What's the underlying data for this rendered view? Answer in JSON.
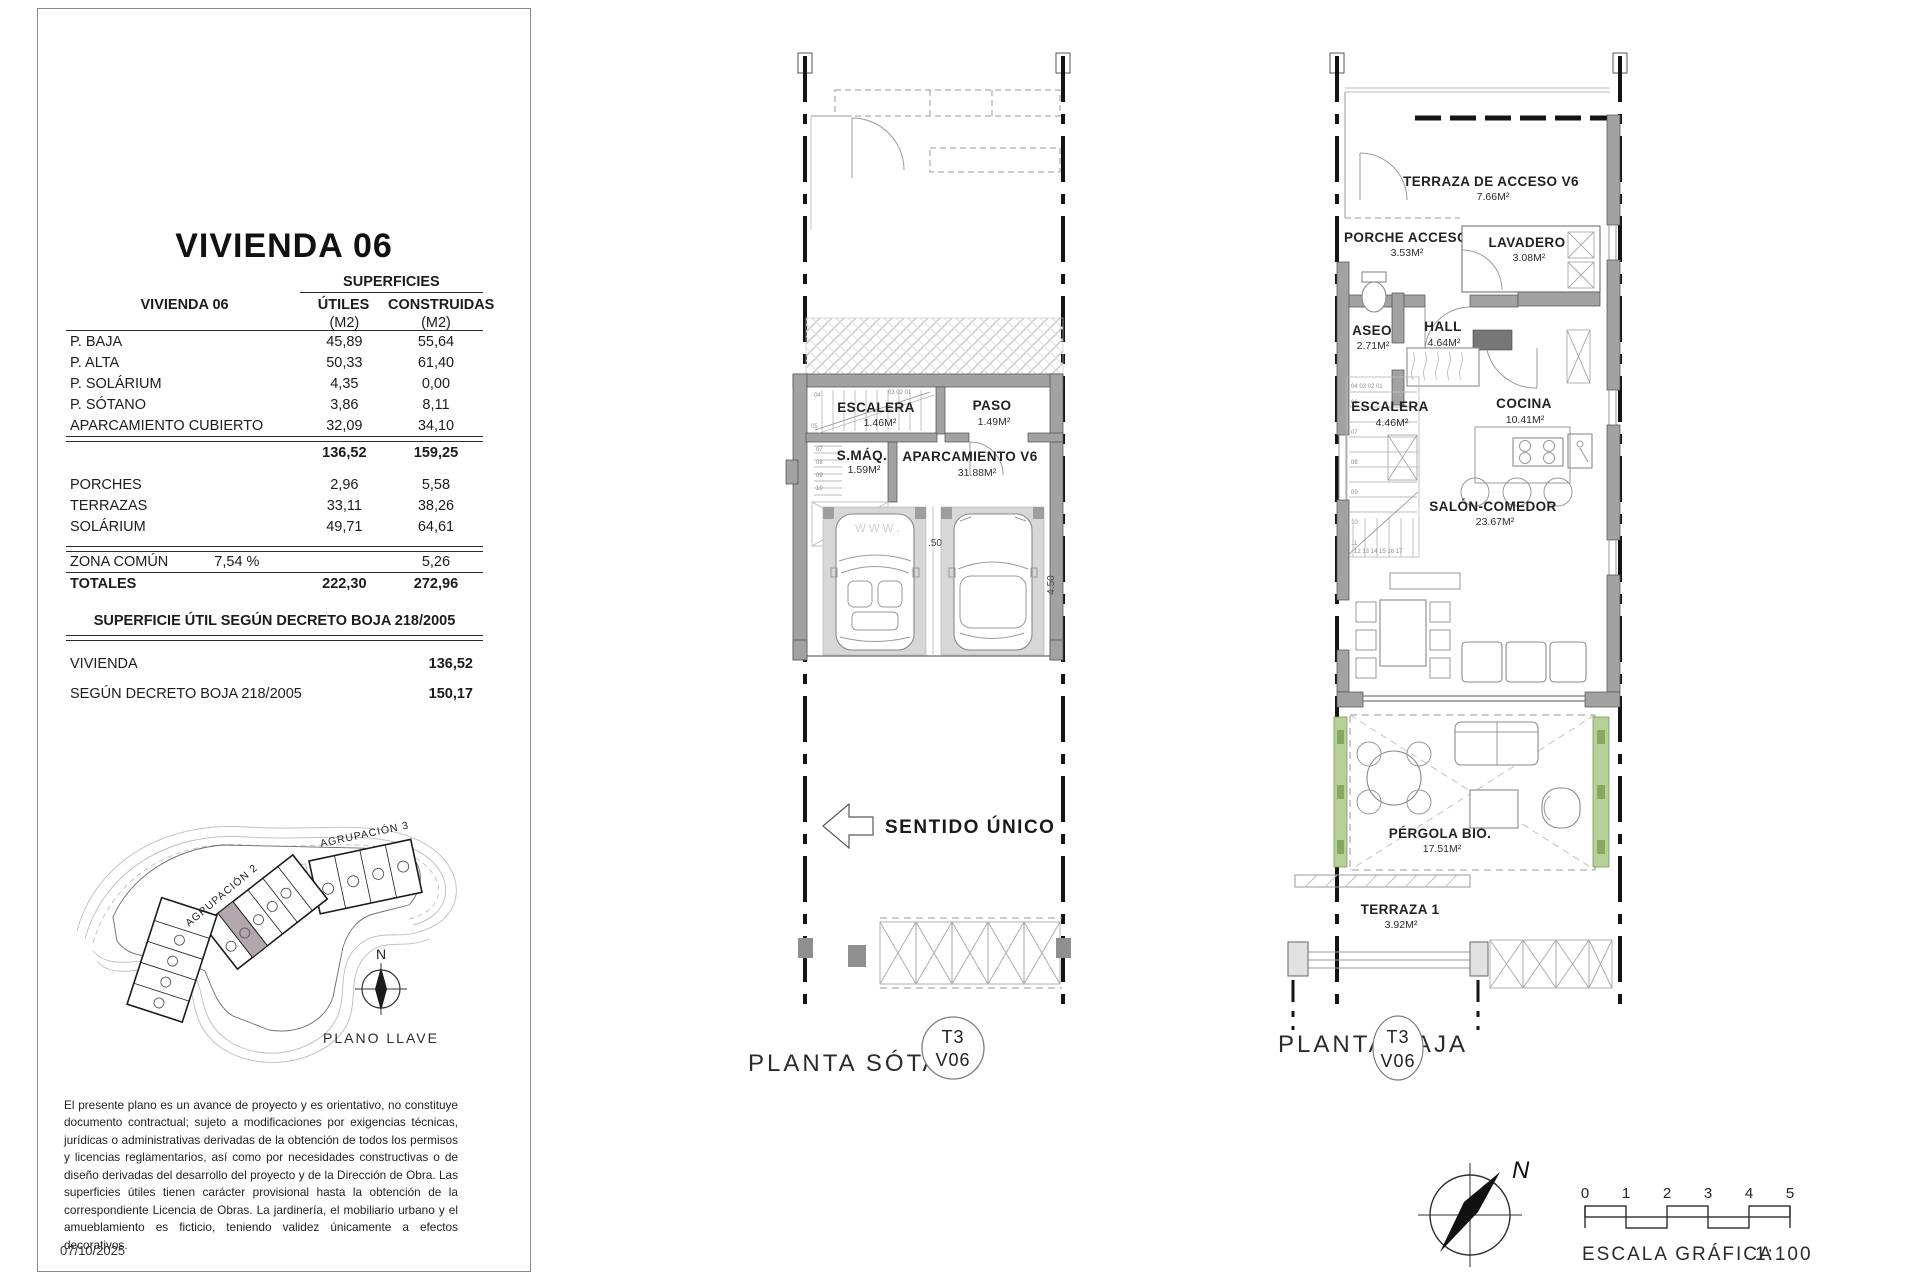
{
  "page": {
    "date": "07/10/2025",
    "watermark": "www."
  },
  "unit": {
    "title": "VIVIENDA 06"
  },
  "areas_table": {
    "group_header": "SUPERFICIES",
    "row_header": "VIVIENDA 06",
    "col_utiles": "ÚTILES",
    "col_construidas": "CONSTRUIDAS",
    "unit_label": "(M2)",
    "rows": [
      {
        "label": "P. BAJA",
        "utiles": "45,89",
        "construidas": "55,64"
      },
      {
        "label": "P. ALTA",
        "utiles": "50,33",
        "construidas": "61,40"
      },
      {
        "label": "P. SOLÁRIUM",
        "utiles": "4,35",
        "construidas": "0,00"
      },
      {
        "label": "P. SÓTANO",
        "utiles": "3,86",
        "construidas": "8,11"
      },
      {
        "label": "APARCAMIENTO CUBIERTO",
        "utiles": "32,09",
        "construidas": "34,10"
      }
    ],
    "subtotal": {
      "utiles": "136,52",
      "construidas": "159,25"
    },
    "outdoor_rows": [
      {
        "label": "PORCHES",
        "utiles": "2,96",
        "construidas": "5,58"
      },
      {
        "label": "TERRAZAS",
        "utiles": "33,11",
        "construidas": "38,26"
      },
      {
        "label": "SOLÁRIUM",
        "utiles": "49,71",
        "construidas": "64,61"
      }
    ],
    "zona_comun": {
      "label": "ZONA COMÚN",
      "pct": "7,54 %",
      "construidas": "5,26"
    },
    "totales": {
      "label": "TOTALES",
      "utiles": "222,30",
      "construidas": "272,96"
    }
  },
  "decreto": {
    "header": "SUPERFICIE ÚTIL SEGÚN DECRETO BOJA 218/2005",
    "rows": [
      {
        "label": "VIVIENDA",
        "value": "136,52"
      },
      {
        "label": "SEGÚN DECRETO BOJA 218/2005",
        "value": "150,17"
      }
    ]
  },
  "site_plan": {
    "caption": "PLANO LLAVE",
    "north": "N",
    "group1": "AGRUPACIÓN 1",
    "group2": "AGRUPACIÓN 2",
    "group3": "AGRUPACIÓN 3",
    "highlight_color": "#b3a6ad"
  },
  "disclaimer": "El presente plano es un avance de proyecto y es orientativo, no constituye documento contractual; sujeto a modificaciones por exigencias técnicas, jurídicas o administrativas derivadas de la obtención de todos los permisos y licencias reglamentarios, así como por necesidades constructivas o de diseño derivadas del desarrollo del proyecto y de la Dirección de Obra. Las superficies útiles tienen carácter provisional hasta la obtención de la correspondiente Licencia de Obras. La jardinería, el mobiliario urbano y el amueblamiento es ficticio, teniendo validez únicamente a efectos decorativos.",
  "sotano": {
    "caption": "PLANTA SÓTANO",
    "badge_top": "T3",
    "badge_bottom": "V06",
    "escalera": {
      "label": "ESCALERA",
      "area": "1.46M²"
    },
    "paso": {
      "label": "PASO",
      "area": "1.49M²"
    },
    "smaq": {
      "label": "S.MÁQ.",
      "area": "1.59M²"
    },
    "aparcamiento": {
      "label": "APARCAMIENTO V6",
      "area": "31.88M²"
    },
    "sentido": "SENTIDO ÚNICO",
    "dims": {
      "bay1": "2.20",
      "gap": ".50",
      "bay2": "2.20",
      "depth": "4.50"
    },
    "tread_labels": {
      "a": "04",
      "b": "03  02  01",
      "c": "05",
      "d": "07",
      "e": "08",
      "f": "09",
      "g": "10"
    }
  },
  "baja": {
    "caption": "PLANTA BAJA",
    "badge_top": "T3",
    "badge_bottom": "V06",
    "terraza_acceso": {
      "label": "TERRAZA DE ACCESO V6",
      "area": "7.66M²"
    },
    "porche": {
      "label": "PORCHE ACCESO",
      "area": "3.53M²"
    },
    "lavadero": {
      "label": "LAVADERO",
      "area": "3.08M²"
    },
    "aseo": {
      "label": "ASEO",
      "area": "2.71M²"
    },
    "hall": {
      "label": "HALL",
      "area": "4.64M²"
    },
    "escalera": {
      "label": "ESCALERA",
      "area": "4.46M²"
    },
    "cocina": {
      "label": "COCINA",
      "area": "10.41M²"
    },
    "salon": {
      "label": "SALÓN-COMEDOR",
      "area": "23.67M²"
    },
    "pergola": {
      "label": "PÉRGOLA BIO.",
      "area": "17.51M²"
    },
    "terraza1": {
      "label": "TERRAZA 1",
      "area": "3.92M²"
    },
    "tread_labels": {
      "top": "04  03  02  01",
      "left": [
        "06",
        "07",
        "08",
        "09",
        "10",
        "11"
      ],
      "bottom": "12    13    14    15    16    17"
    }
  },
  "scalebar": {
    "n0": "0",
    "n1": "1",
    "n2": "2",
    "n3": "3",
    "n4": "4",
    "n5": "5",
    "caption": "ESCALA GRÁFICA",
    "ratio": "1:100"
  }
}
